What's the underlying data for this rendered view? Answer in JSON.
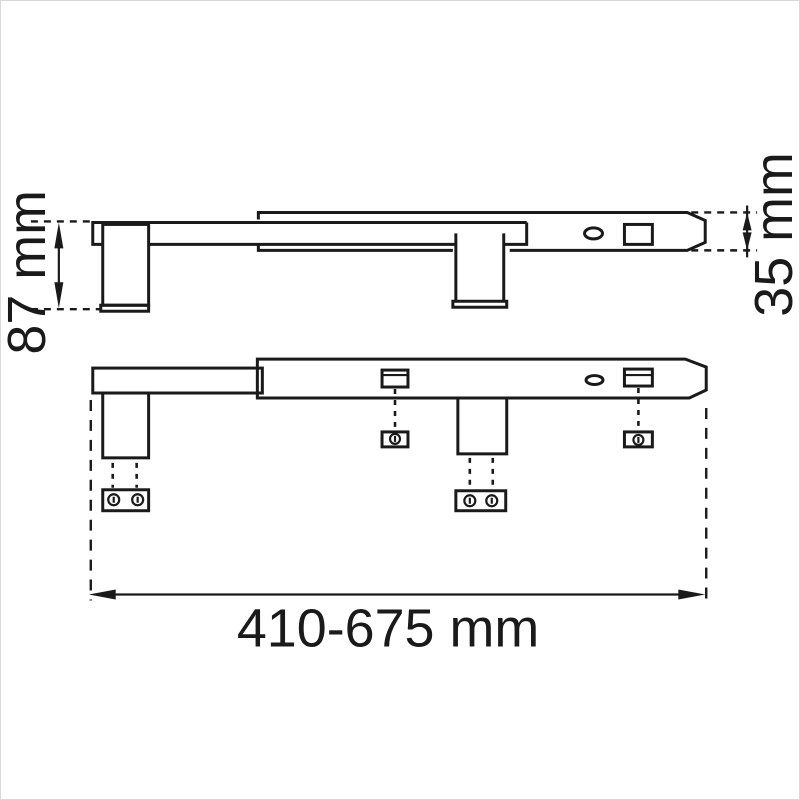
{
  "colors": {
    "line": "#1a1a1a",
    "background": "#ffffff"
  },
  "dimensions": {
    "bracket_height": {
      "label": "87 mm"
    },
    "tube_height": {
      "label": "35 mm"
    },
    "overall_length": {
      "label": "410-675 mm"
    }
  }
}
